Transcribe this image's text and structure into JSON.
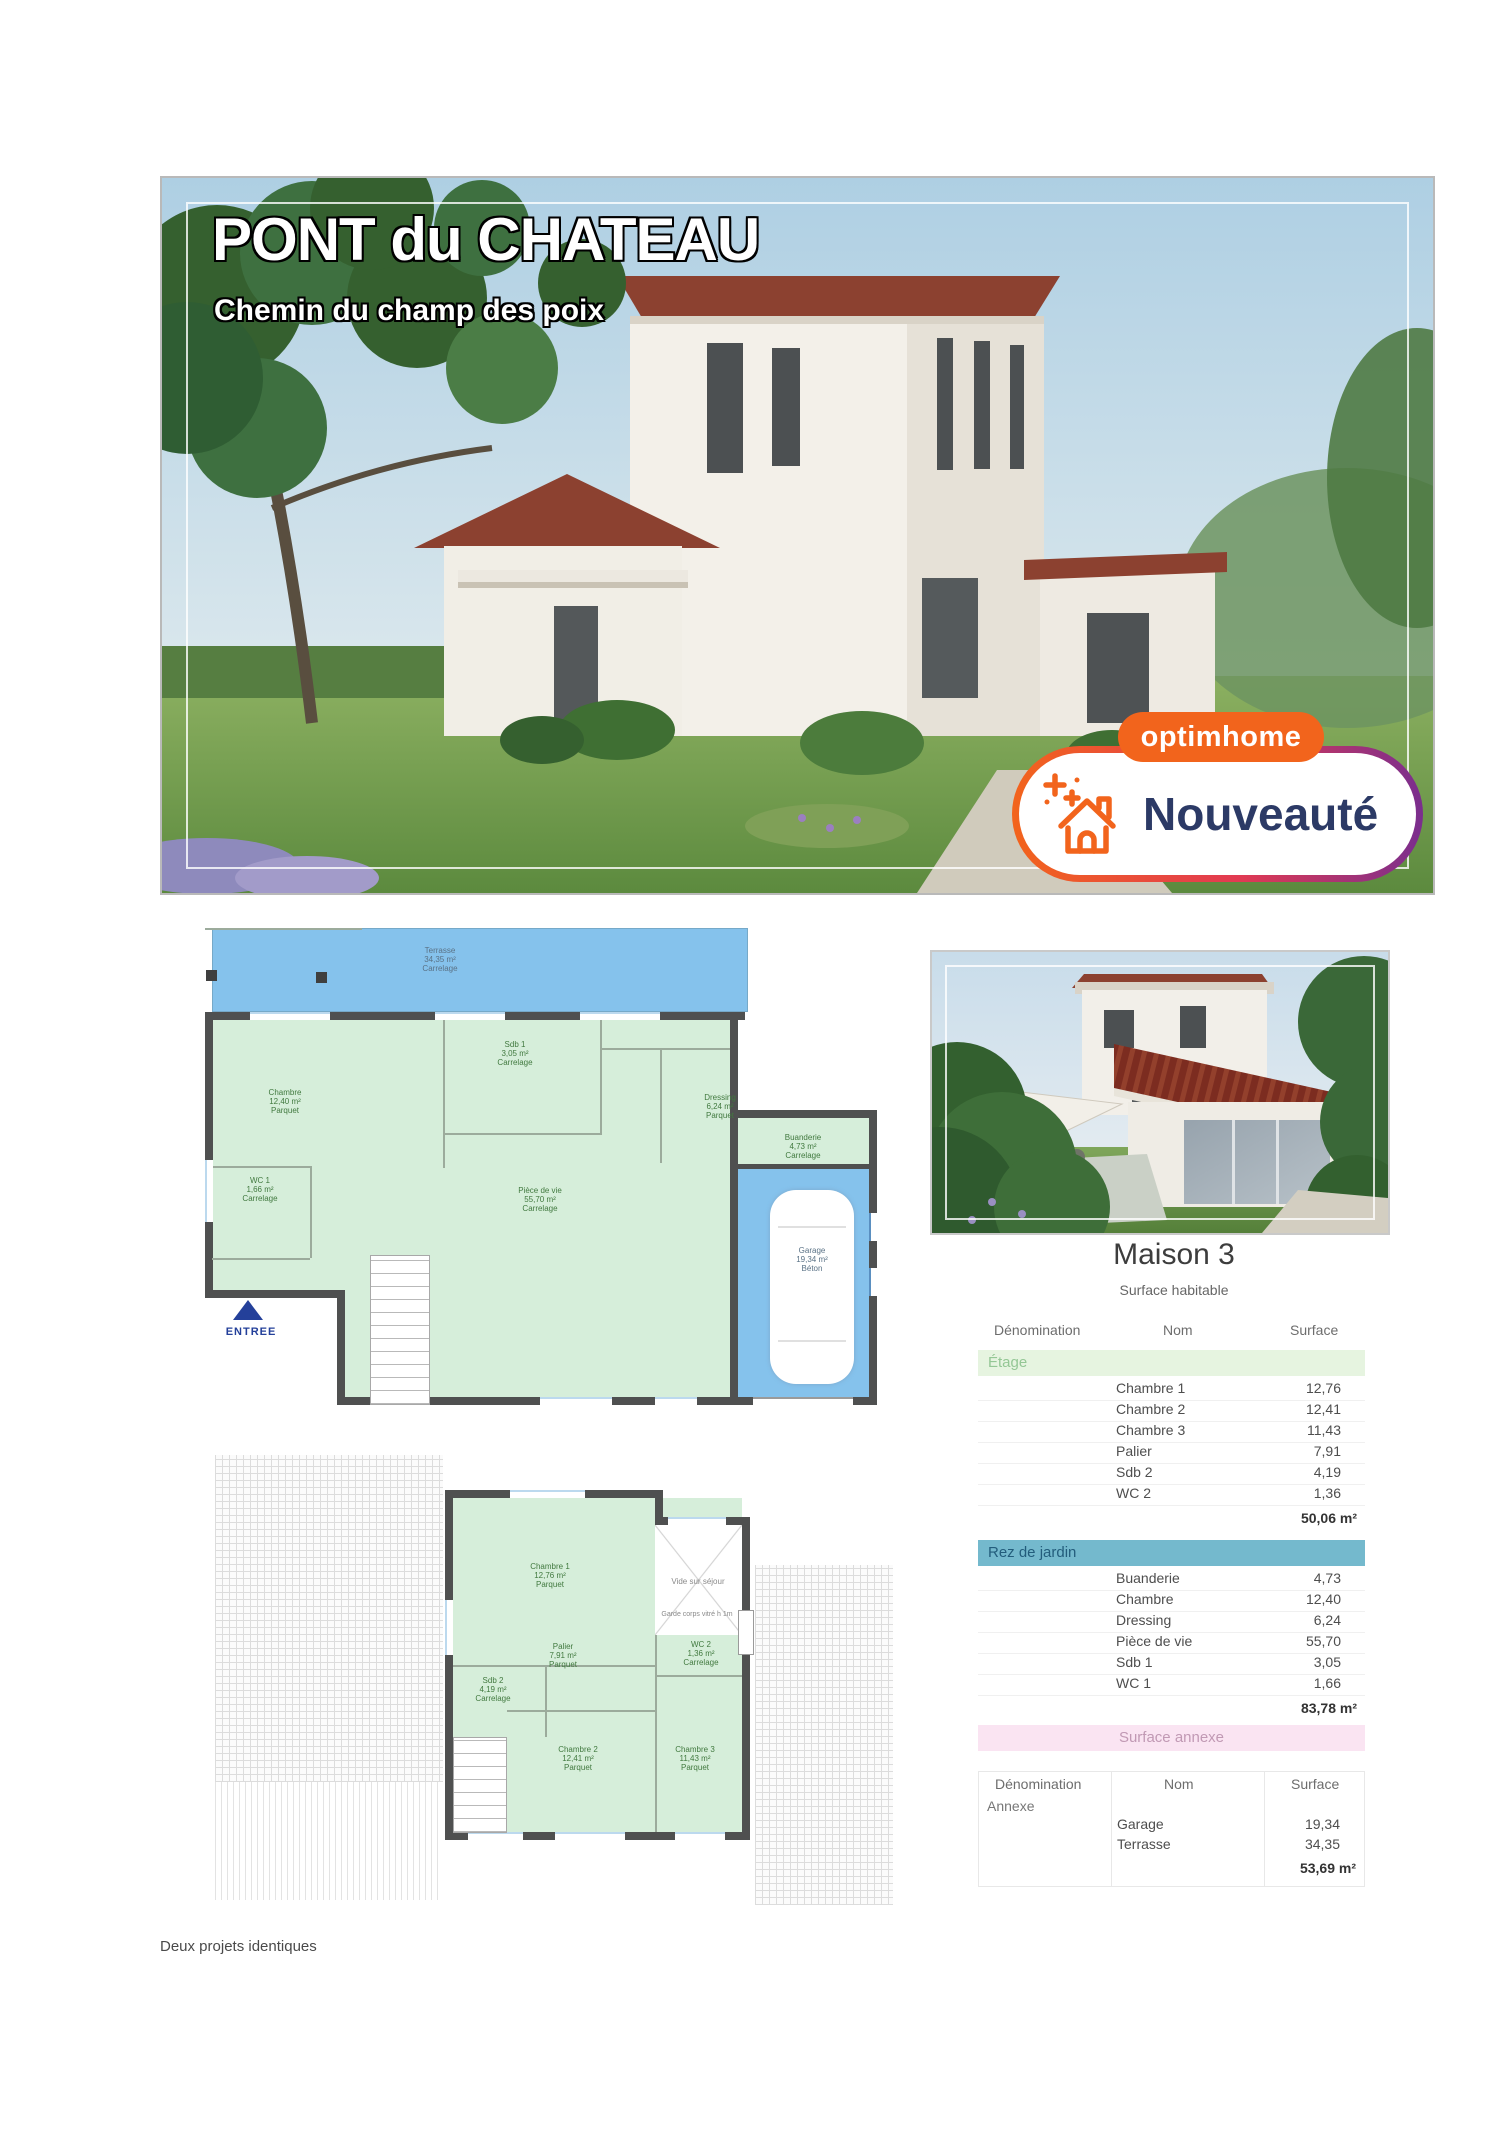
{
  "hero": {
    "title": "PONT du CHATEAU",
    "subtitle": "Chemin du champ des poix",
    "badge": {
      "brand": "optimhome",
      "label": "Nouveauté"
    }
  },
  "plans": {
    "ground": {
      "entree": "ENTREE",
      "terrasse": {
        "name": "Terrasse",
        "area": "34,35 m²",
        "floor": "Carrelage"
      },
      "chambre": {
        "name": "Chambre",
        "area": "12,40 m²",
        "floor": "Parquet"
      },
      "sdb1": {
        "name": "Sdb 1",
        "area": "3,05 m²",
        "floor": "Carrelage"
      },
      "dressing": {
        "name": "Dressing",
        "area": "6,24 m²",
        "floor": "Parquet"
      },
      "wc1": {
        "name": "WC 1",
        "area": "1,66 m²",
        "floor": "Carrelage"
      },
      "piece": {
        "name": "Pièce de vie",
        "area": "55,70 m²",
        "floor": "Carrelage"
      },
      "buanderie": {
        "name": "Buanderie",
        "area": "4,73 m²",
        "floor": "Carrelage"
      },
      "garage": {
        "name": "Garage",
        "area": "19,34 m²",
        "floor": "Béton"
      }
    },
    "floor": {
      "chambre1": {
        "name": "Chambre 1",
        "area": "12,76 m²",
        "floor": "Parquet"
      },
      "sdb2": {
        "name": "Sdb 2",
        "area": "4,19 m²",
        "floor": "Carrelage"
      },
      "palier": {
        "name": "Palier",
        "area": "7,91 m²",
        "floor": "Parquet"
      },
      "wc2": {
        "name": "WC 2",
        "area": "1,36 m²",
        "floor": "Carrelage"
      },
      "chambre2": {
        "name": "Chambre 2",
        "area": "12,41 m²",
        "floor": "Parquet"
      },
      "chambre3": {
        "name": "Chambre 3",
        "area": "11,43 m²",
        "floor": "Parquet"
      },
      "vide": "Vide sur séjour",
      "garde": "Garde corps vitré h 1m"
    }
  },
  "tables": {
    "main": {
      "title": "Maison 3",
      "subtitle": "Surface habitable",
      "headers": {
        "denomination": "Dénomination",
        "nom": "Nom",
        "surface": "Surface"
      },
      "etage": {
        "label": "Étage",
        "rows": [
          {
            "nom": "Chambre 1",
            "surface": "12,76"
          },
          {
            "nom": "Chambre 2",
            "surface": "12,41"
          },
          {
            "nom": "Chambre 3",
            "surface": "11,43"
          },
          {
            "nom": "Palier",
            "surface": "7,91"
          },
          {
            "nom": "Sdb 2",
            "surface": "4,19"
          },
          {
            "nom": "WC 2",
            "surface": "1,36"
          }
        ],
        "total": "50,06 m²"
      },
      "rez": {
        "label": "Rez de jardin",
        "rows": [
          {
            "nom": "Buanderie",
            "surface": "4,73"
          },
          {
            "nom": "Chambre",
            "surface": "12,40"
          },
          {
            "nom": "Dressing",
            "surface": "6,24"
          },
          {
            "nom": "Pièce de vie",
            "surface": "55,70"
          },
          {
            "nom": "Sdb 1",
            "surface": "3,05"
          },
          {
            "nom": "WC 1",
            "surface": "1,66"
          }
        ],
        "total": "83,78 m²",
        "grand_total": "133,84 m²"
      }
    },
    "annexe": {
      "banner": "Surface annexe",
      "headers": {
        "denomination": "Dénomination",
        "nom": "Nom",
        "surface": "Surface"
      },
      "section": "Annexe",
      "rows": [
        {
          "nom": "Garage",
          "surface": "19,34"
        },
        {
          "nom": "Terrasse",
          "surface": "34,35"
        }
      ],
      "total": "53,69 m²"
    }
  },
  "footer": "Deux projets identiques",
  "colors": {
    "accent_orange": "#f2641c",
    "accent_purple": "#7a2e8e",
    "badge_text": "#2c3a66",
    "banner_teal": "#74b9cd",
    "banner_green": "#e6f4e0",
    "banner_pink": "#fae4f2",
    "plan_green": "#d6eeda",
    "plan_blue": "#85c2ec",
    "roof_red": "#8c4130"
  }
}
